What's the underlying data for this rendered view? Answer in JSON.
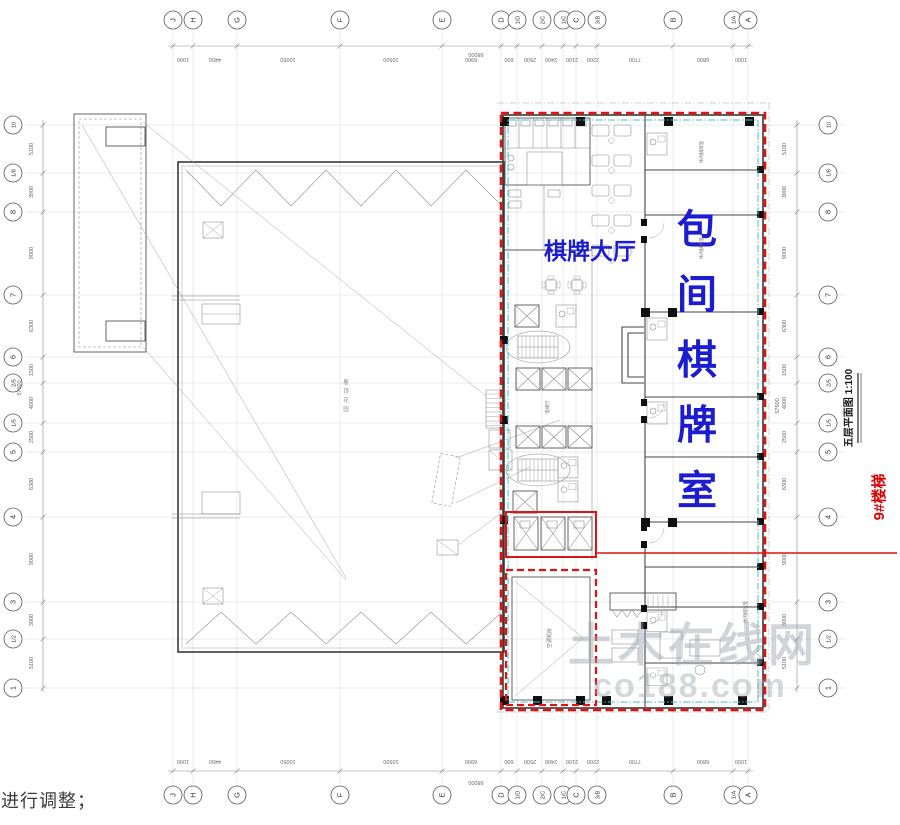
{
  "note": "进行调整；",
  "drawing": {
    "title": "五层平面图  1:100",
    "hall_label": "棋牌大厅",
    "private_room_label": "包间棋牌室",
    "stair_callout": "9#楼梯",
    "roof_label": "屋顶花园",
    "ac_room_label": "空调机房",
    "elevator_hall_label": "电梯厅",
    "leisure_room_label": "休闲棋牌室",
    "watermark_line1": "土木在线网",
    "watermark_line2": "co188.com"
  },
  "colors": {
    "highlight_red": "#e01212",
    "inner_cyan": "#49c2c2",
    "label_blue": "#1d1dd0",
    "callout_red": "#dd0000",
    "watermark_gray": "#9aa2aa"
  },
  "grid": {
    "cols": [
      {
        "label": "J",
        "x": 173
      },
      {
        "label": "H",
        "x": 193
      },
      {
        "label": "G",
        "x": 237
      },
      {
        "label": "F",
        "x": 340
      },
      {
        "label": "E",
        "x": 442
      },
      {
        "label": "D",
        "x": 501
      },
      {
        "label": "1/D",
        "x": 517
      },
      {
        "label": "2/C",
        "x": 542
      },
      {
        "label": "1/C",
        "x": 563
      },
      {
        "label": "C",
        "x": 576
      },
      {
        "label": "3/B",
        "x": 597
      },
      {
        "label": "B",
        "x": 673
      },
      {
        "label": "1/A",
        "x": 733
      },
      {
        "label": "A",
        "x": 748
      }
    ],
    "rows": [
      {
        "label": "10",
        "y": 125
      },
      {
        "label": "1/8",
        "y": 173
      },
      {
        "label": "8",
        "y": 212
      },
      {
        "label": "7",
        "y": 295
      },
      {
        "label": "6",
        "y": 357
      },
      {
        "label": "2/5",
        "y": 383
      },
      {
        "label": "1/5",
        "y": 423
      },
      {
        "label": "5",
        "y": 452
      },
      {
        "label": "4",
        "y": 517
      },
      {
        "label": "3",
        "y": 602
      },
      {
        "label": "1/2",
        "y": 639
      },
      {
        "label": "1",
        "y": 688
      }
    ]
  },
  "dims": {
    "top": [
      {
        "t": "1000",
        "x": 183
      },
      {
        "t": "4450",
        "x": 215
      },
      {
        "t": "10050",
        "x": 288
      },
      {
        "t": "10500",
        "x": 391
      },
      {
        "t": "6900",
        "x": 471
      },
      {
        "t": "600",
        "x": 509
      },
      {
        "t": "2500",
        "x": 530
      },
      {
        "t": "2400",
        "x": 551
      },
      {
        "t": "2100",
        "x": 572
      },
      {
        "t": "2200",
        "x": 593
      },
      {
        "t": "7700",
        "x": 635
      },
      {
        "t": "6800",
        "x": 703
      },
      {
        "t": "1000",
        "x": 741
      }
    ],
    "bottom": [
      {
        "t": "1000",
        "x": 183
      },
      {
        "t": "4450",
        "x": 215
      },
      {
        "t": "10050",
        "x": 288
      },
      {
        "t": "10500",
        "x": 391
      },
      {
        "t": "6900",
        "x": 471
      },
      {
        "t": "600",
        "x": 509
      },
      {
        "t": "2500",
        "x": 530
      },
      {
        "t": "2400",
        "x": 551
      },
      {
        "t": "2100",
        "x": 572
      },
      {
        "t": "2200",
        "x": 593
      },
      {
        "t": "7700",
        "x": 635
      },
      {
        "t": "6800",
        "x": 703
      },
      {
        "t": "1000",
        "x": 741
      }
    ],
    "left": [
      {
        "t": "5100",
        "y": 149
      },
      {
        "t": "3900",
        "y": 192
      },
      {
        "t": "9000",
        "y": 253
      },
      {
        "t": "6300",
        "y": 326
      },
      {
        "t": "1500",
        "y": 370
      },
      {
        "t": "4000",
        "y": 403
      },
      {
        "t": "2500",
        "y": 437
      },
      {
        "t": "6300",
        "y": 484
      },
      {
        "t": "9000",
        "y": 559
      },
      {
        "t": "3900",
        "y": 620
      },
      {
        "t": "5100",
        "y": 663
      }
    ],
    "right": [
      {
        "t": "5100",
        "y": 149
      },
      {
        "t": "3900",
        "y": 192
      },
      {
        "t": "9000",
        "y": 253
      },
      {
        "t": "6300",
        "y": 326
      },
      {
        "t": "1500",
        "y": 370
      },
      {
        "t": "4000",
        "y": 403
      },
      {
        "t": "2500",
        "y": 437
      },
      {
        "t": "6300",
        "y": 484
      },
      {
        "t": "9000",
        "y": 559
      },
      {
        "t": "3900",
        "y": 620
      },
      {
        "t": "5100",
        "y": 663
      }
    ],
    "totals": [
      {
        "t": "58000",
        "x": 476,
        "y": 53,
        "rot": 180
      },
      {
        "t": "58000",
        "x": 476,
        "y": 781,
        "rot": 180
      },
      {
        "t": "57600",
        "x": 21,
        "y": 388,
        "rot": -90
      },
      {
        "t": "57600",
        "x": 779,
        "y": 406,
        "rot": -90
      }
    ]
  },
  "labels": [
    {
      "key": "hall",
      "text": "棋牌大厅",
      "x": 590,
      "y": 259,
      "size": 23,
      "color": "#1d1dd0",
      "weight": "bold"
    },
    {
      "key": "private",
      "text": "包间棋牌室",
      "x": 697,
      "y": 243,
      "size": 40,
      "mode": "vchars",
      "color": "#1d1dd0",
      "weight": "bold"
    },
    {
      "key": "stair",
      "text": "9#楼梯",
      "x": 884,
      "y": 497,
      "rot": -90,
      "size": 15,
      "color": "#dd0000",
      "weight": "bold"
    },
    {
      "key": "title",
      "text": "五层平面图  1:100",
      "x": 852,
      "y": 408,
      "rot": -90,
      "size": 10,
      "color": "#1a1a1a",
      "weight": "bold"
    },
    {
      "key": "roof",
      "text": "屋顶花园",
      "x": 346,
      "y": 384,
      "size": 5.5,
      "mode": "vchars",
      "color": "#8a8a8a"
    },
    {
      "key": "acroom",
      "text": "空调机房",
      "x": 551,
      "y": 638,
      "rot": -90,
      "size": 5,
      "color": "#777"
    },
    {
      "key": "elevhall",
      "text": "电梯厅",
      "x": 549,
      "y": 407,
      "rot": -90,
      "size": 4.5,
      "color": "#777"
    },
    {
      "key": "leisure1",
      "text": "休闲棋牌室",
      "x": 703,
      "y": 152,
      "rot": -90,
      "size": 4.5,
      "color": "#777"
    },
    {
      "key": "leisure2",
      "text": "休闲棋牌室",
      "x": 703,
      "y": 248,
      "rot": -90,
      "size": 4.5,
      "color": "#777"
    },
    {
      "key": "leisure3",
      "text": "休闲棋牌室",
      "x": 747,
      "y": 612,
      "rot": -90,
      "size": 4.5,
      "color": "#777"
    },
    {
      "key": "wm1",
      "text": "土木在线网",
      "x": 693,
      "y": 661,
      "size": 46,
      "color": "#9aa2aa",
      "weight": "bold",
      "opacity": 0.45,
      "spacing": 4
    },
    {
      "key": "wm2",
      "text": "co188.com",
      "x": 690,
      "y": 697,
      "size": 34,
      "color": "#9aa2aa",
      "weight": "bold",
      "opacity": 0.4,
      "spacing": 2
    }
  ]
}
